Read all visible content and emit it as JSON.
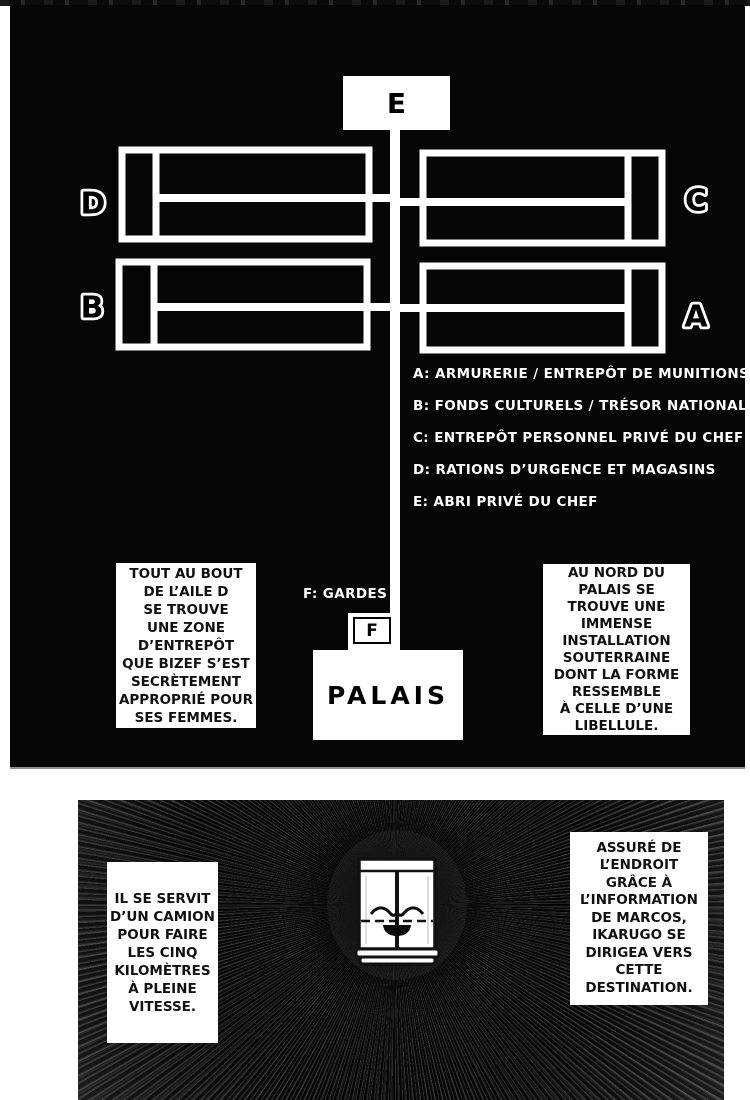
{
  "colors": {
    "panel_bg": "#060606",
    "line": "#ffffff",
    "page_bg": "#ffffff"
  },
  "panel1": {
    "labels": {
      "a": "A",
      "b": "B",
      "c": "C",
      "d": "D",
      "e": "E",
      "f": "F"
    },
    "legend": [
      "A: ARMURERIE / ENTREPÔT DE MUNITIONS",
      "B: FONDS CULTURELS / TRÉSOR NATIONAL",
      "C: ENTREPÔT PERSONNEL PRIVÉ DU CHEF",
      "D: RATIONS D’URGENCE ET MAGASINS",
      "E: ABRI PRIVÉ DU CHEF"
    ],
    "guards_label": "F: GARDES",
    "palais_label": "PALAIS",
    "caption_left": "TOUT AU BOUT\nDE L’AILE D\nSE TROUVE\nUNE ZONE\nD’ENTREPÔT\nQUE BIZEF S’EST\nSECRÈTEMENT\nAPPROPRIÉ POUR\nSES FEMMES.",
    "caption_right": "AU NORD DU\nPALAIS SE\nTROUVE UNE\nIMMENSE\nINSTALLATION\nSOUTERRAINE\nDONT LA FORME\nRESSEMBLE\nÀ CELLE D’UNE\nLIBELLULE."
  },
  "panel2": {
    "caption_left": "IL SE SERVIT\nD’UN CAMION\nPOUR FAIRE\nLES CINQ\nKILOMÈTRES\nÀ PLEINE\nVITESSE.",
    "caption_right": "ASSURÉ DE\nL’ENDROIT\nGRÂCE À\nL’INFORMATION\nDE MARCOS,\nIKARUGO SE\nDIRIGEA VERS\nCETTE\nDESTINATION."
  }
}
